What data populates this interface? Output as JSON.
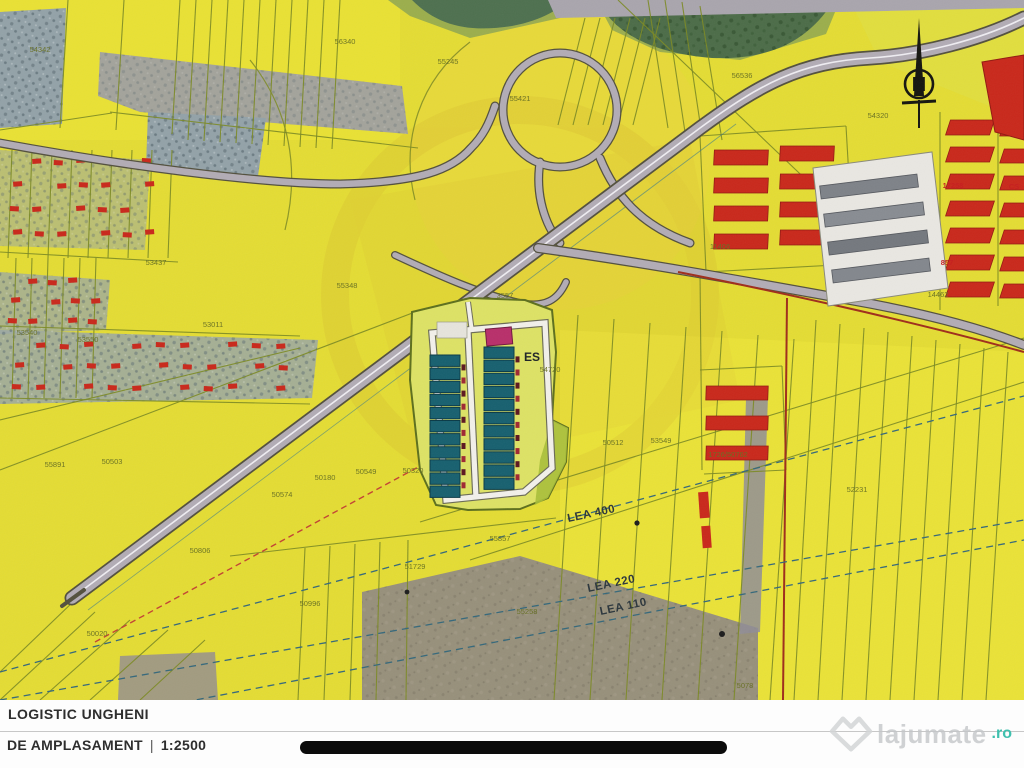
{
  "palette": {
    "base_yellow": "#e3dc38",
    "bright_yellow": "#eee73f",
    "olive_line": "#7c8a26",
    "road_fill": "#b2acb5",
    "road_casing": "#53503e",
    "road_median": "#efedf2",
    "teal_building": "#19606e",
    "teal_stroke": "#0a3a46",
    "magenta_building": "#b53069",
    "red_building": "#c5291c",
    "red_building_stroke": "#8f1a12",
    "scrub_gray": "#93a2a8",
    "forest_green": "#4d6c49",
    "brown_area": "#97907c",
    "red_line": "#9c2e1c",
    "power_line": "#36687a",
    "label_olive": "#676f24",
    "label_red": "#c21f1f",
    "black_bar": "#0b0b0b",
    "watermark_gray": "#c3c6c8",
    "watermark_teal": "#3fc0ae"
  },
  "map": {
    "compass_letter": "N",
    "warehouse": {
      "left_bays": 11,
      "right_bays": 11
    },
    "labels": [
      {
        "text": "54342",
        "x": 40,
        "y": 52,
        "cls": "lbl-t"
      },
      {
        "text": "56340",
        "x": 345,
        "y": 44,
        "cls": "lbl-t"
      },
      {
        "text": "55245",
        "x": 448,
        "y": 64,
        "cls": "lbl-t"
      },
      {
        "text": "55421",
        "x": 520,
        "y": 101,
        "cls": "lbl-t"
      },
      {
        "text": "56536",
        "x": 742,
        "y": 78,
        "cls": "lbl-t"
      },
      {
        "text": "54320",
        "x": 878,
        "y": 118,
        "cls": "lbl-t"
      },
      {
        "text": "53437",
        "x": 156,
        "y": 265,
        "cls": "lbl-t"
      },
      {
        "text": "55348",
        "x": 347,
        "y": 288,
        "cls": "lbl-t"
      },
      {
        "text": "53011",
        "x": 213,
        "y": 327,
        "cls": "lbl-t"
      },
      {
        "text": "53540",
        "x": 27,
        "y": 335,
        "cls": "lbl-t"
      },
      {
        "text": "53550",
        "x": 88,
        "y": 342,
        "cls": "lbl-t"
      },
      {
        "text": "3557",
        "x": 505,
        "y": 298,
        "cls": "lbl-t"
      },
      {
        "text": "50574",
        "x": 282,
        "y": 497,
        "cls": "lbl-t"
      },
      {
        "text": "50180",
        "x": 325,
        "y": 480,
        "cls": "lbl-t"
      },
      {
        "text": "50549",
        "x": 366,
        "y": 474,
        "cls": "lbl-t"
      },
      {
        "text": "50320",
        "x": 413,
        "y": 473,
        "cls": "lbl-t"
      },
      {
        "text": "50512",
        "x": 613,
        "y": 445,
        "cls": "lbl-t"
      },
      {
        "text": "53549",
        "x": 661,
        "y": 443,
        "cls": "lbl-t"
      },
      {
        "text": "1726/50762",
        "x": 728,
        "y": 457,
        "cls": "lbl-t"
      },
      {
        "text": "52231",
        "x": 857,
        "y": 492,
        "cls": "lbl-t"
      },
      {
        "text": "55891",
        "x": 55,
        "y": 467,
        "cls": "lbl-t"
      },
      {
        "text": "50503",
        "x": 112,
        "y": 464,
        "cls": "lbl-t"
      },
      {
        "text": "50806",
        "x": 200,
        "y": 553,
        "cls": "lbl-t"
      },
      {
        "text": "50996",
        "x": 310,
        "y": 606,
        "cls": "lbl-t"
      },
      {
        "text": "50020",
        "x": 97,
        "y": 636,
        "cls": "lbl-t"
      },
      {
        "text": "51729",
        "x": 415,
        "y": 569,
        "cls": "lbl-t"
      },
      {
        "text": "55857",
        "x": 500,
        "y": 541,
        "cls": "lbl-t"
      },
      {
        "text": "55258",
        "x": 527,
        "y": 614,
        "cls": "lbl-t"
      },
      {
        "text": "5078",
        "x": 745,
        "y": 688,
        "cls": "lbl-t"
      },
      {
        "text": "11406",
        "x": 720,
        "y": 249,
        "cls": "lbl-t"
      },
      {
        "text": "14462",
        "x": 938,
        "y": 297,
        "cls": "lbl-t"
      },
      {
        "text": "54720",
        "x": 550,
        "y": 372,
        "cls": "lbl-t"
      },
      {
        "text": "17258",
        "x": 953,
        "y": 188,
        "cls": "lbl-r"
      },
      {
        "text": "CS",
        "x": 1014,
        "y": 189,
        "cls": "lbl-r"
      },
      {
        "text": "857",
        "x": 947,
        "y": 265,
        "cls": "lbl-r"
      },
      {
        "text": "LEA 400",
        "x": 592,
        "y": 517,
        "cls": "lbl-lea",
        "rot": -12
      },
      {
        "text": "LEA 220",
        "x": 612,
        "y": 587,
        "cls": "lbl-lea",
        "rot": -12
      },
      {
        "text": "LEA 110",
        "x": 624,
        "y": 610,
        "cls": "lbl-lea",
        "rot": -12
      },
      {
        "text": "ES",
        "x": 532,
        "y": 361,
        "cls": "lbl-es"
      }
    ]
  },
  "footer": {
    "project_title": "LOGISTIC UNGHENI",
    "plan_label": "DE AMPLASAMENT",
    "separator": "|",
    "scale": "1:2500",
    "watermark_name": "lajumate",
    "watermark_tld": ".ro"
  }
}
